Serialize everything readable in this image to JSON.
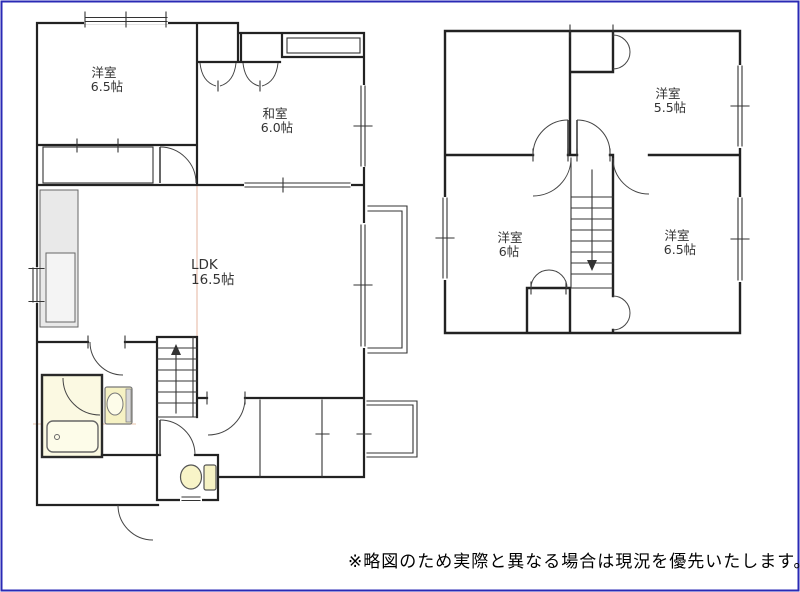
{
  "document": {
    "type": "floor-plan",
    "disclaimer": "※略図のため実際と異なる場合は現況を優先いたします。"
  },
  "floor1": {
    "rooms": [
      {
        "name": "洋室",
        "size": "6.5帖"
      },
      {
        "name": "和室",
        "size": "6.0帖"
      },
      {
        "name": "LDK",
        "size": "16.5帖"
      }
    ],
    "fixtures": [
      "bathtub",
      "washbasin",
      "toilet",
      "kitchen-counter",
      "stairs-up"
    ]
  },
  "floor2": {
    "rooms": [
      {
        "name": "洋室",
        "size": "5.5帖"
      },
      {
        "name": "洋室",
        "size": "6帖"
      },
      {
        "name": "洋室",
        "size": "6.5帖"
      }
    ],
    "fixtures": [
      "stairs-down"
    ]
  },
  "colors": {
    "frame_border": "#2a2ab5",
    "wall": "#222222",
    "fixture_fill": "#f6f2c4",
    "bath_room_fill": "#fbf9e2",
    "fold_line": "#eccabb"
  }
}
